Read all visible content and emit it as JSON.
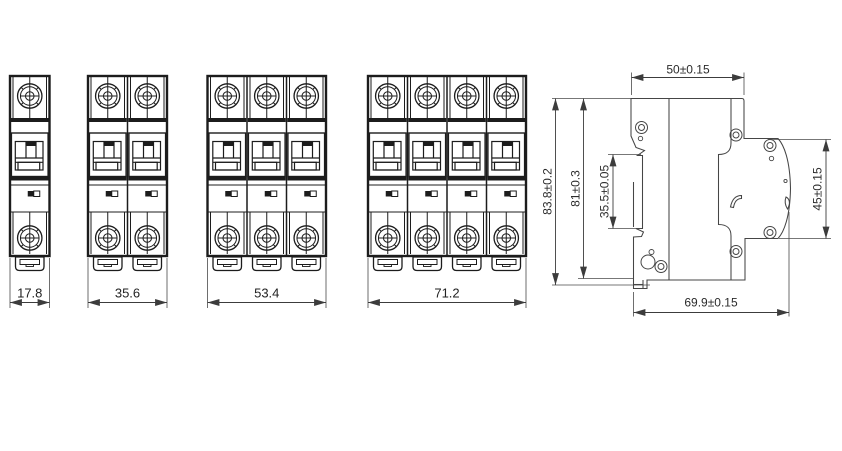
{
  "drawing": {
    "title": "Miniature circuit breaker outline drawing",
    "front_views": [
      {
        "poles": 1,
        "width_mm": "17.8"
      },
      {
        "poles": 2,
        "width_mm": "35.6"
      },
      {
        "poles": 3,
        "width_mm": "53.4"
      },
      {
        "poles": 4,
        "width_mm": "71.2"
      }
    ],
    "side_view": {
      "top_width": "50±0.15",
      "overall_height": "83.8±0.2",
      "body_height": "81±0.3",
      "din_slot_height": "35.5±0.05",
      "front_face_height": "45±0.15",
      "overall_depth": "69.9±0.15"
    },
    "colors": {
      "line": "#1c1c1c",
      "side_line": "#454545",
      "dimension": "#3c3c3c",
      "background": "#ffffff"
    }
  }
}
